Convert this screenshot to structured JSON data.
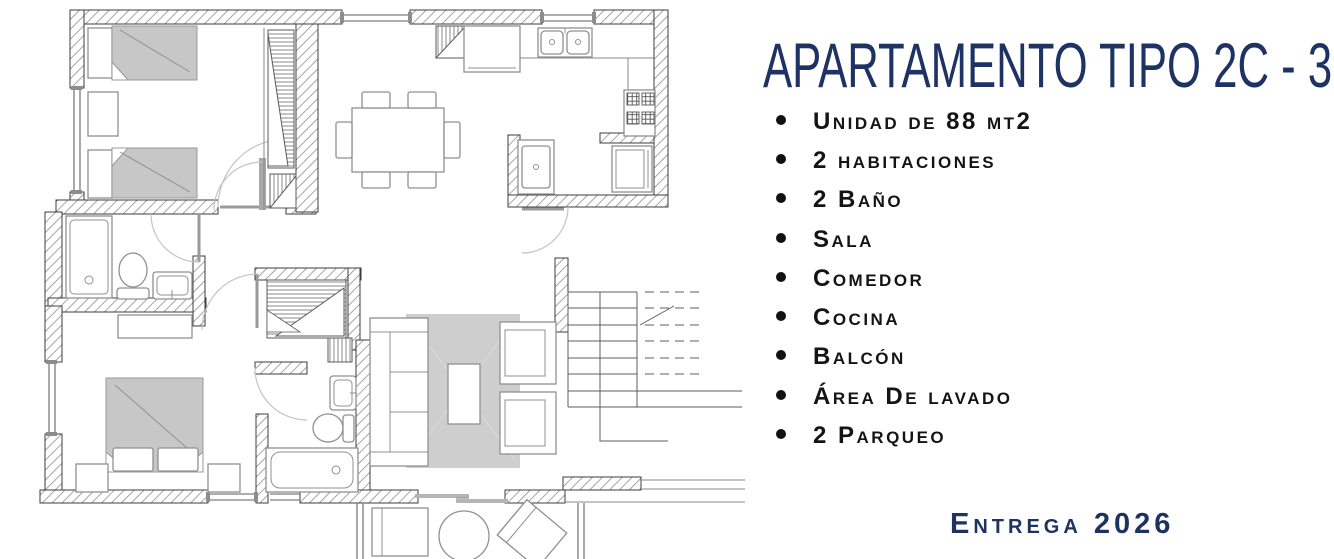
{
  "panel": {
    "title": "APARTAMENTO TIPO 2C - 3C",
    "features": [
      "Unidad de 88 mt2",
      "2 habitaciones",
      "2 Baño",
      "Sala",
      "Comedor",
      "Cocina",
      "Balcón",
      "Área De lavado",
      "2 Parqueo"
    ],
    "delivery": "Entrega 2026"
  },
  "colors": {
    "accent_navy": "#1e3263",
    "list_text": "#141414",
    "furniture_gray": "#c7c7c7",
    "wall_outline": "#3c3c3c"
  },
  "icons": {
    "bullet": "filled-circle"
  }
}
